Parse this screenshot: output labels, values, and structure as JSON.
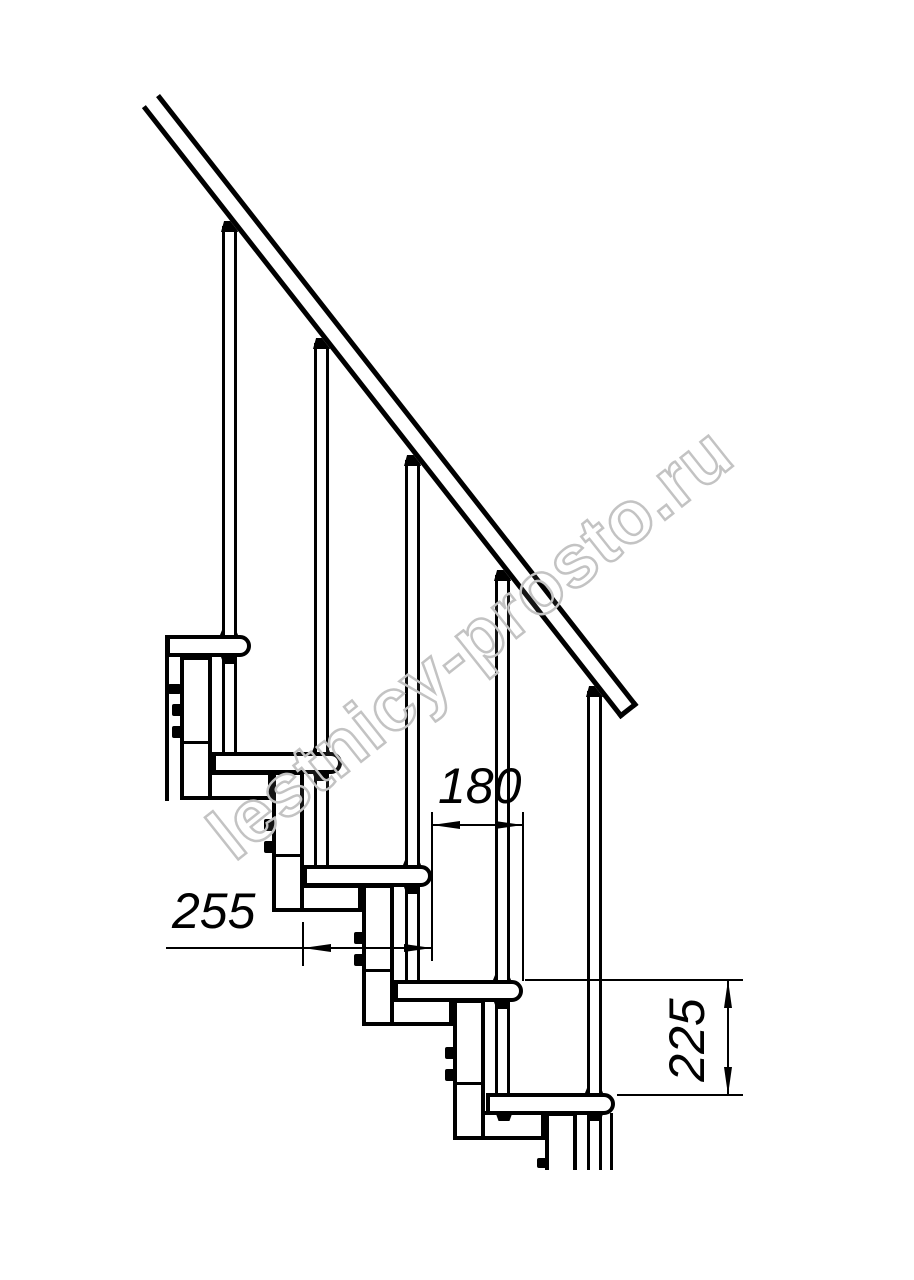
{
  "drawing": {
    "type": "modular staircase side-view technical drawing",
    "watermark": {
      "text": "lestnicy-prosto.ru",
      "color": "#c3c3c3"
    },
    "colors": {
      "line": "#000000",
      "background": "#ffffff"
    },
    "dims": {
      "tread_depth": {
        "value": "255"
      },
      "step_run": {
        "value": "180"
      },
      "step_rise": {
        "value": "225"
      }
    }
  }
}
